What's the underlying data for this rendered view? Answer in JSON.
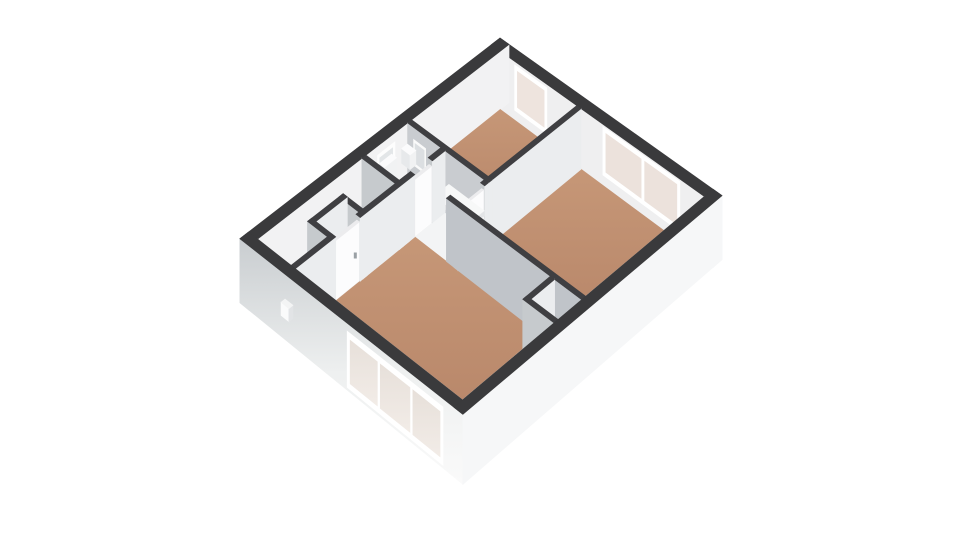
{
  "page": {
    "background": "#ffffff",
    "description": "3D isometric floor plan render of an apartment, no visible text"
  },
  "palette": {
    "wall_top": "#3a3a3c",
    "interior_wall_top": "#3f3f42",
    "wall_shaded_face": "#c6cacd",
    "wall_light_face": "#ebedef",
    "far_wall_inner_face": "#efeff0",
    "exterior_face_bright": "#f6f7f8",
    "floor_wood": "#bd8b6e",
    "floor_light": "#f3f4f5",
    "window_pane": "#ece2dc",
    "window_frame": "#ffffff",
    "door": "#fcfcfd",
    "handle": "#9aa0a5"
  },
  "floorplan": {
    "rooms": [
      {
        "name": "small-bedroom",
        "floor": "wood",
        "window": "single, north-east wall"
      },
      {
        "name": "large-bedroom",
        "floor": "wood",
        "window": "double, north-east wall"
      },
      {
        "name": "living-room",
        "floor": "wood",
        "window": "triple, south-west wall"
      },
      {
        "name": "hall",
        "floor": "light"
      },
      {
        "name": "toilet",
        "floor": "light",
        "fixtures": [
          "toilet",
          "sink",
          "mirror",
          "small window"
        ]
      },
      {
        "name": "closet",
        "floor": "light"
      }
    ],
    "projection": {
      "origin": [
        500,
        38
      ],
      "eu": [
        30.0,
        21.3
      ],
      "ev": [
        -28.9,
        22.3
      ],
      "warp": [
        1,
        18
      ],
      "U": 7.4,
      "V": 9.0,
      "wall_px_base": 58,
      "wall_px_persp": 12
    },
    "elements": [
      {
        "t": "box",
        "id": "ext-wall-ne",
        "u": [
          0,
          7.4
        ],
        "v": [
          0,
          0.3
        ],
        "f": {
          "top": "#3a3a3c",
          "s": "#efeff0",
          "e": "#f4f5f6"
        },
        "fc": [
          "s",
          "e",
          "top"
        ]
      },
      {
        "t": "rects",
        "id": "window-small-bedroom-frame",
        "v": 0.3,
        "u": [
          0.78,
          1.85
        ],
        "z": [
          0.17,
          0.94
        ],
        "f": "#ffffff"
      },
      {
        "t": "rects",
        "id": "window-small-bedroom-pane",
        "v": 0.3,
        "u": [
          0.87,
          1.76
        ],
        "z": [
          0.25,
          0.86
        ],
        "f": "#eee4de"
      },
      {
        "t": "rects",
        "id": "window-large-bedroom-frame",
        "v": 0.3,
        "u": [
          3.72,
          6.28
        ],
        "z": [
          0.17,
          0.96
        ],
        "f": "#ffffff"
      },
      {
        "t": "rects",
        "id": "window-large-bedroom-pane-left",
        "v": 0.3,
        "u": [
          3.82,
          4.99
        ],
        "z": [
          0.25,
          0.88
        ],
        "f": "#ece2dc"
      },
      {
        "t": "rects",
        "id": "window-large-bedroom-pane-right",
        "v": 0.3,
        "u": [
          5.11,
          6.18
        ],
        "z": [
          0.25,
          0.88
        ],
        "f": "#ece2dc"
      },
      {
        "t": "box",
        "id": "ext-wall-nw",
        "u": [
          0,
          0.3
        ],
        "v": [
          0,
          9
        ],
        "f": {
          "top": "#3a3a3c",
          "s": "#e9ebec",
          "e": "#f2f2f3"
        },
        "fc": [
          "s",
          "e",
          "top"
        ]
      },
      {
        "t": "recte",
        "id": "toilet-window-frame",
        "u": 0.3,
        "v": [
          3.95,
          4.55
        ],
        "z": [
          0.36,
          0.85
        ],
        "f": "#fdfdfd"
      },
      {
        "t": "recte",
        "id": "toilet-window-pane",
        "u": 0.3,
        "v": [
          4.03,
          4.47
        ],
        "z": [
          0.43,
          0.78
        ],
        "f": "#e3e6e8"
      },
      {
        "t": "floor",
        "id": "floor-small-bedroom",
        "u": [
          0.3,
          2.85
        ],
        "v": [
          0.3,
          3.37
        ],
        "f": "url(#gWood)"
      },
      {
        "t": "floor",
        "id": "floor-large-bedroom",
        "u": [
          2.99,
          7.1
        ],
        "v": [
          0.3,
          4.42
        ],
        "f": "url(#gWood)"
      },
      {
        "t": "floor",
        "id": "floor-toilet",
        "u": [
          0.3,
          1.41
        ],
        "v": [
          3.51,
          4.95
        ],
        "f": "#f3f4f5"
      },
      {
        "t": "floor",
        "id": "floor-hall-vestibule",
        "u": [
          1.55,
          2.85
        ],
        "v": [
          3.51,
          4.42
        ],
        "f": "#f3f4f5"
      },
      {
        "t": "floor",
        "id": "floor-hall-passage",
        "u": [
          1.55,
          2.6
        ],
        "v": [
          4.42,
          4.56
        ],
        "f": "#f3f4f5"
      },
      {
        "t": "floor",
        "id": "floor-hall-corridor",
        "u": [
          0.3,
          1.55
        ],
        "v": [
          4.56,
          8.7
        ],
        "f": "#f3f4f5"
      },
      {
        "t": "floor",
        "id": "floor-living-room",
        "u": [
          1.55,
          7.1
        ],
        "v": [
          4.56,
          8.7
        ],
        "f": "url(#gWood)"
      },
      {
        "t": "rects",
        "id": "ext-wall-sw-inner-face",
        "v": 8.7,
        "u": [
          0.3,
          7.1
        ],
        "z": [
          0,
          1
        ],
        "f": "#f4f4f5"
      },
      {
        "t": "recte",
        "id": "ext-wall-se-inner-face",
        "u": 7.1,
        "v": [
          0.3,
          8.7
        ],
        "z": [
          0,
          1
        ],
        "f": "#f5f5f6"
      },
      {
        "t": "box",
        "id": "wall-bedroom-divider",
        "u": [
          2.85,
          2.99
        ],
        "v": [
          0.3,
          3.51
        ],
        "f": {
          "top": "#3f3f42",
          "s": "#c6cacd",
          "e": "#ebedef"
        }
      },
      {
        "t": "box",
        "id": "wall-small-bedroom-south",
        "u": [
          0.3,
          2.99
        ],
        "v": [
          3.37,
          3.51
        ],
        "f": {
          "top": "#3f3f42",
          "s": "#c9ccd0",
          "e": "#ebedef"
        }
      },
      {
        "t": "rects",
        "id": "toilet-mirror-frame",
        "v": 3.51,
        "u": [
          0.5,
          0.9
        ],
        "z": [
          0.38,
          0.8
        ],
        "f": "#fafafa"
      },
      {
        "t": "rects",
        "id": "toilet-mirror",
        "v": 3.51,
        "u": [
          0.55,
          0.85
        ],
        "z": [
          0.43,
          0.75
        ],
        "f": "#dcdfe2"
      },
      {
        "t": "box",
        "id": "toilet-cistern",
        "u": [
          0.34,
          0.5
        ],
        "v": [
          4.1,
          4.52
        ],
        "z": [
          0,
          0.72
        ],
        "f": {
          "top": "#fbfbfc",
          "s": "#e7e9eb",
          "e": "#f1f2f3"
        }
      },
      {
        "t": "box",
        "id": "toilet-pan",
        "u": [
          0.5,
          0.74
        ],
        "v": [
          4.14,
          4.48
        ],
        "z": [
          0,
          0.4
        ],
        "f": {
          "top": "#fbfbfc",
          "s": "#e7e9eb",
          "e": "#f1f2f3"
        }
      },
      {
        "t": "box",
        "id": "toilet-sink",
        "u": [
          0.36,
          0.64
        ],
        "v": [
          3.58,
          3.78
        ],
        "z": [
          0.46,
          0.7
        ],
        "f": {
          "top": "#fbfbfc",
          "s": "#e7e9eb",
          "e": "#f1f2f3"
        }
      },
      {
        "t": "box",
        "id": "wall-vestibule-east-a",
        "u": [
          2.85,
          2.99
        ],
        "v": [
          3.51,
          3.64
        ],
        "f": {
          "top": "#3f3f42",
          "s": "#c6cacd",
          "e": "#ebedef"
        }
      },
      {
        "t": "box",
        "id": "wall-vestibule-east-b",
        "u": [
          2.85,
          2.99
        ],
        "v": [
          4.32,
          4.56
        ],
        "f": {
          "top": "#3f3f42",
          "s": "#c6cacd",
          "e": "#ebedef"
        }
      },
      {
        "t": "box",
        "id": "door-large-bedroom",
        "u": [
          2.89,
          2.95
        ],
        "v": [
          3.64,
          4.32
        ],
        "z": [
          0,
          0.92
        ],
        "f": {
          "top": "#ececee",
          "s": "#e2e3e5",
          "e": "#fcfcfd"
        }
      },
      {
        "t": "handle",
        "id": "door-large-bedroom-handle",
        "p": [
          2.96,
          4.18,
          0.45
        ]
      },
      {
        "t": "box",
        "id": "open-door-panel",
        "u": [
          1.78,
          2.95
        ],
        "v": [
          3.62,
          4.12
        ],
        "z": [
          0.5,
          0.58
        ],
        "f": {
          "top": "#f7f8f8",
          "s": "#d9dbdd",
          "e": "#e3e5e7"
        }
      },
      {
        "t": "box",
        "id": "wall-toilet-east-a",
        "u": [
          1.41,
          1.55
        ],
        "v": [
          3.51,
          3.95
        ],
        "f": {
          "top": "#3f3f42",
          "s": "#c6cacd",
          "e": "#ebedef"
        }
      },
      {
        "t": "box",
        "id": "door-toilet",
        "u": [
          1.44,
          1.52
        ],
        "v": [
          3.95,
          4.75
        ],
        "z": [
          0,
          0.9
        ],
        "f": {
          "top": "#ececee",
          "s": "#e2e3e5",
          "e": "#fcfcfd"
        }
      },
      {
        "t": "box",
        "id": "wall-toilet-east-b",
        "u": [
          1.41,
          1.55
        ],
        "v": [
          4.75,
          5.09
        ],
        "f": {
          "top": "#3f3f42",
          "s": "#c6cacd",
          "e": "#ebedef"
        }
      },
      {
        "t": "box",
        "id": "wall-toilet-south",
        "u": [
          0.3,
          1.55
        ],
        "v": [
          4.95,
          5.09
        ],
        "f": {
          "top": "#3f3f42",
          "s": "#c6cacd",
          "e": "#ebedef"
        }
      },
      {
        "t": "box",
        "id": "wall-living-north",
        "u": [
          2.6,
          7.1
        ],
        "v": [
          4.42,
          4.56
        ],
        "f": {
          "top": "#3f3f42",
          "s": "#c0c4c9",
          "e": "#ebedef"
        }
      },
      {
        "t": "floor",
        "id": "floor-closet",
        "u": [
          6.2,
          7.1
        ],
        "v": [
          4.56,
          5.38
        ],
        "f": "#f3f4f5"
      },
      {
        "t": "box",
        "id": "wall-closet-west",
        "u": [
          6.06,
          6.2
        ],
        "v": [
          4.56,
          5.52
        ],
        "f": {
          "top": "#3f3f42",
          "s": "#c6cacd",
          "e": "#ebedef"
        }
      },
      {
        "t": "box",
        "id": "wall-closet-south",
        "u": [
          6.06,
          7.1
        ],
        "v": [
          5.38,
          5.52
        ],
        "f": {
          "top": "#3f3f42",
          "s": "#c6cacd",
          "e": "#ebedef"
        }
      },
      {
        "t": "box",
        "id": "wall-niche-north",
        "u": [
          0.75,
          1.55
        ],
        "v": [
          6.21,
          6.35
        ],
        "f": {
          "top": "#3f3f42",
          "s": "#c6cacd",
          "e": "#ebedef"
        }
      },
      {
        "t": "box",
        "id": "wall-niche-west",
        "u": [
          0.75,
          0.89
        ],
        "v": [
          6.21,
          7.44
        ],
        "f": {
          "top": "#3f3f42",
          "s": "#c6cacd",
          "e": "#ebedef"
        }
      },
      {
        "t": "box",
        "id": "wall-niche-south",
        "u": [
          0.75,
          1.55
        ],
        "v": [
          7.3,
          7.44
        ],
        "f": {
          "top": "#3f3f42",
          "s": "#c6cacd",
          "e": "#ebedef"
        }
      },
      {
        "t": "box",
        "id": "wall-living-west-a",
        "u": [
          1.41,
          1.55
        ],
        "v": [
          4.56,
          6.45
        ],
        "f": {
          "top": "#3f3f42",
          "s": "#c6cacd",
          "e": "#ebedef"
        }
      },
      {
        "t": "box",
        "id": "door-living-room",
        "u": [
          1.44,
          1.52
        ],
        "v": [
          6.45,
          7.3
        ],
        "z": [
          0,
          0.92
        ],
        "f": {
          "top": "#ececee",
          "s": "#e2e3e5",
          "e": "#fcfcfd"
        }
      },
      {
        "t": "handle",
        "id": "door-living-room-handle",
        "p": [
          1.53,
          6.6,
          0.45
        ]
      },
      {
        "t": "box",
        "id": "wall-living-west-b",
        "u": [
          1.41,
          1.55
        ],
        "v": [
          7.3,
          8.7
        ],
        "f": {
          "top": "#3f3f42",
          "s": "#c6cacd",
          "e": "#ebedef"
        }
      },
      {
        "t": "box",
        "id": "ext-wall-sw",
        "u": [
          0,
          7.4
        ],
        "v": [
          8.7,
          9
        ],
        "f": {
          "top": "#3a3a3c",
          "s": "url(#gExt)"
        },
        "fc": [
          "s",
          "top"
        ]
      },
      {
        "t": "rects",
        "id": "window-living-frame",
        "v": 9,
        "u": [
          3.56,
          6.74
        ],
        "z": [
          0.04,
          0.88
        ],
        "f": "#ffffff"
      },
      {
        "t": "rects",
        "id": "window-living-pane-1",
        "v": 9,
        "u": [
          3.66,
          4.56
        ],
        "z": [
          0.13,
          0.78
        ],
        "f": "url(#gPane)"
      },
      {
        "t": "rects",
        "id": "window-living-pane-2",
        "v": 9,
        "u": [
          4.66,
          5.64
        ],
        "z": [
          0.13,
          0.78
        ],
        "f": "url(#gPane)"
      },
      {
        "t": "rects",
        "id": "window-living-pane-3",
        "v": 9,
        "u": [
          5.74,
          6.64
        ],
        "z": [
          0.13,
          0.78
        ],
        "f": "url(#gPane)"
      },
      {
        "t": "box",
        "id": "exterior-vent",
        "u": [
          1.5,
          1.76
        ],
        "v": [
          9.0,
          9.14
        ],
        "z": [
          0.42,
          0.62
        ],
        "f": {
          "top": "#f3f4f4",
          "s": "#fafbfb",
          "e": "#e2e4e6"
        },
        "fc": [
          "s",
          "e",
          "top"
        ]
      },
      {
        "t": "box",
        "id": "ext-wall-se",
        "u": [
          7.1,
          7.4
        ],
        "v": [
          0,
          9
        ],
        "f": {
          "top": "#3a3a3c",
          "e": "#f6f7f8"
        },
        "fc": [
          "e",
          "top"
        ]
      }
    ]
  }
}
